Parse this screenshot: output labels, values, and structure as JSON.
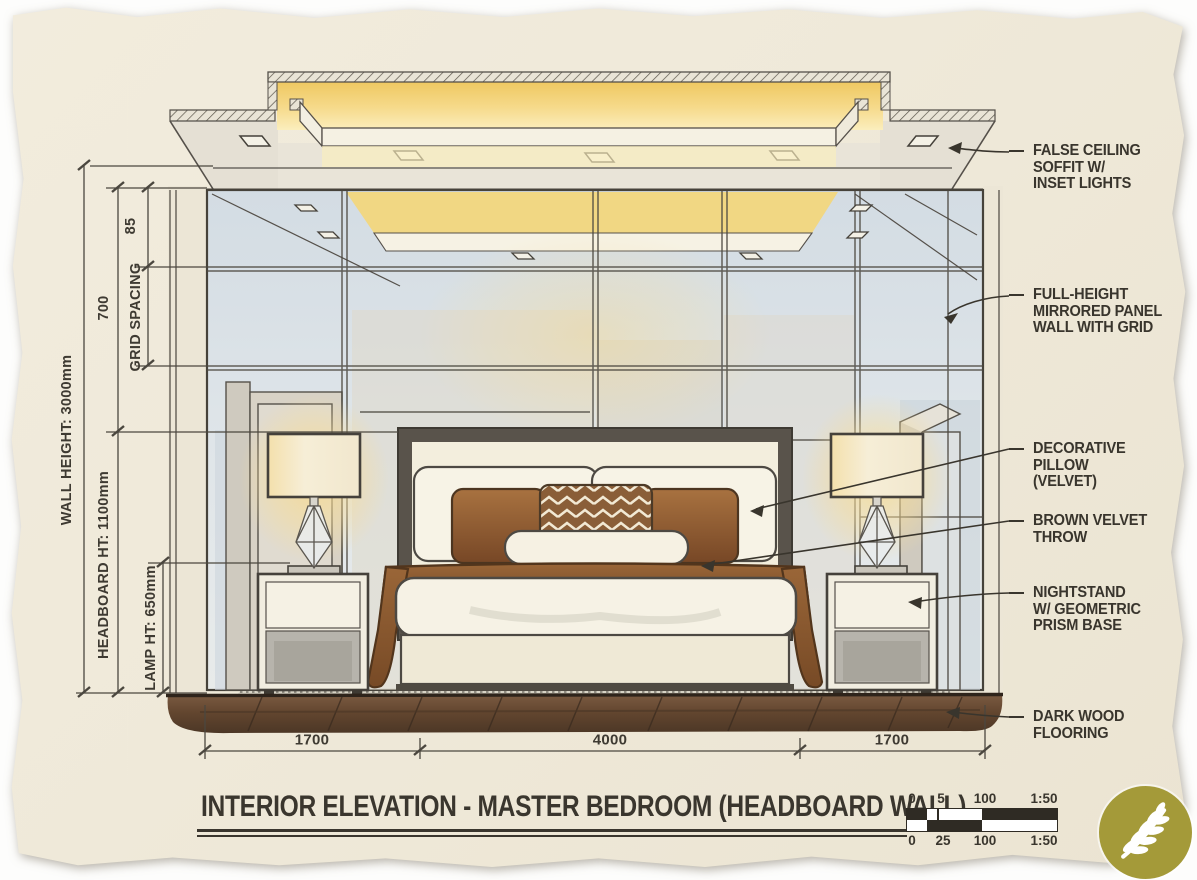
{
  "drawing": {
    "type": "interior elevation sketch",
    "room": "master bedroom headboard wall"
  },
  "title_block": {
    "title": "INTERIOR ELEVATION - MASTER BEDROOM (HEADBOARD WALL)"
  },
  "dimensions_left": {
    "wall_height": "WALL HEIGHT: 3000mm",
    "headboard_height": "HEADBOARD HT: 1100mm",
    "lamp_height": "LAMP HT: 650mm",
    "grid_spacing_label": "GRID SPACING",
    "grid_dim_upper": "85",
    "grid_dim_lower": "700"
  },
  "dimensions_bottom": {
    "left": "1700",
    "center": "4000",
    "right": "1700"
  },
  "callouts": [
    {
      "id": "false-ceiling",
      "lines": [
        "FALSE CEILING",
        "SOFFIT W/",
        "INSET LIGHTS"
      ]
    },
    {
      "id": "mirror-wall",
      "lines": [
        "FULL-HEIGHT",
        "MIRRORED PANEL",
        "WALL WITH GRID"
      ]
    },
    {
      "id": "decorative-pillow",
      "lines": [
        "DECORATIVE",
        "PILLOW",
        "(VELVET)"
      ]
    },
    {
      "id": "velvet-throw",
      "lines": [
        "BROWN VELVET",
        "THROW"
      ]
    },
    {
      "id": "nightstand",
      "lines": [
        "NIGHTSTAND",
        "W/ GEOMETRIC",
        "PRISM BASE"
      ]
    },
    {
      "id": "flooring",
      "lines": [
        "DARK WOOD",
        "FLOORING"
      ]
    }
  ],
  "scale_bar": {
    "top_labels": [
      "0",
      "5",
      "100",
      "1:50"
    ],
    "bottom_labels": [
      "0",
      "25",
      "100",
      "1:50"
    ]
  },
  "logo": {
    "icon": "wheat-branch-icon",
    "color": "#a49a39"
  },
  "colors": {
    "paper": "#efe9d9",
    "ink": "#3e3a32",
    "cove_glow": "#f5d678",
    "mirror_glass": "#dbe2e8",
    "velvet_brown": "#8a5a33",
    "floor_wood": "#5e4430",
    "nightstand_gray": "#b7b4ac"
  }
}
